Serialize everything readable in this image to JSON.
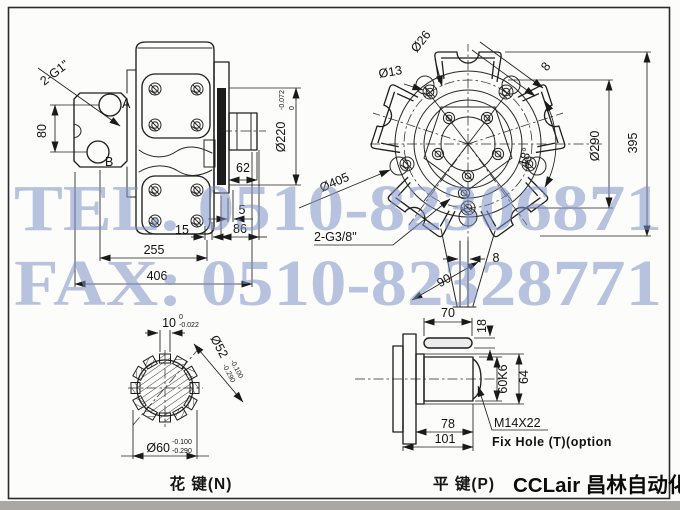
{
  "watermark": {
    "tel": "TEL. 0510-82306871",
    "fax": "FAX: 0510-82328771",
    "color": "#7f93c9"
  },
  "brand": {
    "logo": "CCLair 昌林自动化"
  },
  "side": {
    "port_label": "2-G1\"",
    "port_a": "A",
    "port_b": "B",
    "dims": {
      "d80": "80",
      "d220": "Ø220",
      "d220_tol_up": "0",
      "d220_tol_dn": "-0.072",
      "d62": "62",
      "d5": "5",
      "d15": "15",
      "d86": "86",
      "d255": "255",
      "d406": "406"
    }
  },
  "front": {
    "port_label": "2-G3/8\"",
    "dims": {
      "d26": "Ø26",
      "d13": "Ø13",
      "d8_top": "8",
      "d290": "Ø290",
      "d395": "395",
      "d18": "18°",
      "d405": "Ø405",
      "d8_key": "8",
      "d90": "90"
    }
  },
  "spline": {
    "caption": "花 键(N)",
    "dims": {
      "d10": "10",
      "d10_tol_up": "0",
      "d10_tol_dn": "-0.022",
      "d52": "Ø52",
      "d52_tol_up": "-0.100",
      "d52_tol_dn": "-0.290",
      "d60": "Ø60",
      "d60_tol_up": "-0.100",
      "d60_tol_dn": "-0.290"
    }
  },
  "key": {
    "caption": "平 键(P)",
    "thread": "M14X22",
    "note": "Fix Hole (T)(option",
    "dims": {
      "d70": "70",
      "d18": "18",
      "d60k6": "60K6",
      "d64": "64",
      "d78": "78",
      "d101": "101"
    }
  }
}
